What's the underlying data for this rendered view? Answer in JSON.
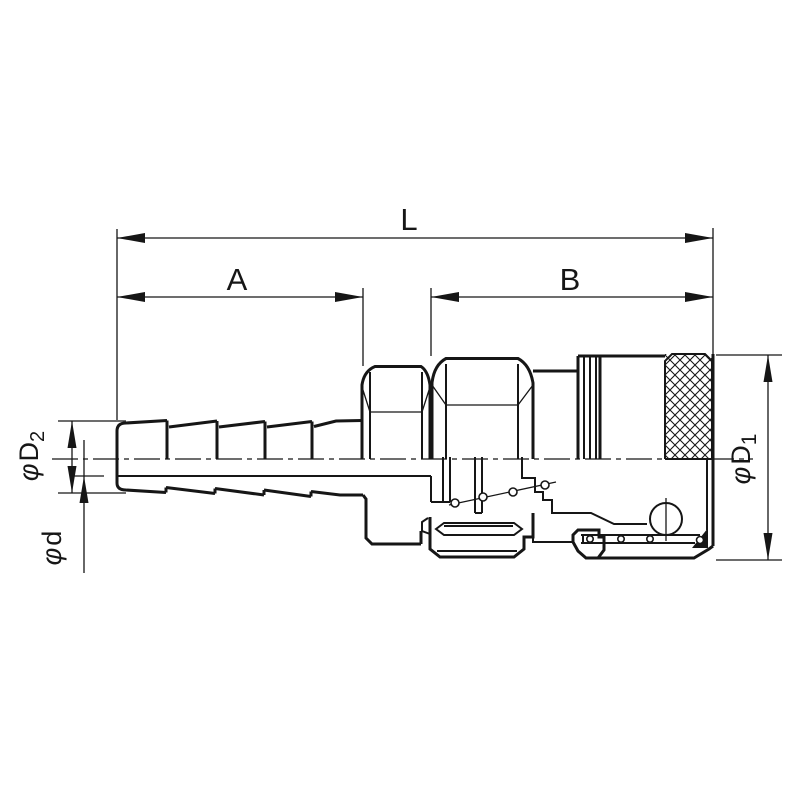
{
  "drawing": {
    "colors": {
      "line": "#161616",
      "background": "#ffffff"
    },
    "dims": {
      "L": {
        "label": "L"
      },
      "A": {
        "label": "A"
      },
      "B": {
        "label": "B"
      },
      "D2": {
        "symbol": "φ",
        "letter": "D",
        "subscript": "2"
      },
      "d": {
        "symbol": "φ",
        "letter": "d"
      },
      "D1": {
        "symbol": "φ",
        "letter": "D",
        "subscript": "1"
      }
    }
  }
}
